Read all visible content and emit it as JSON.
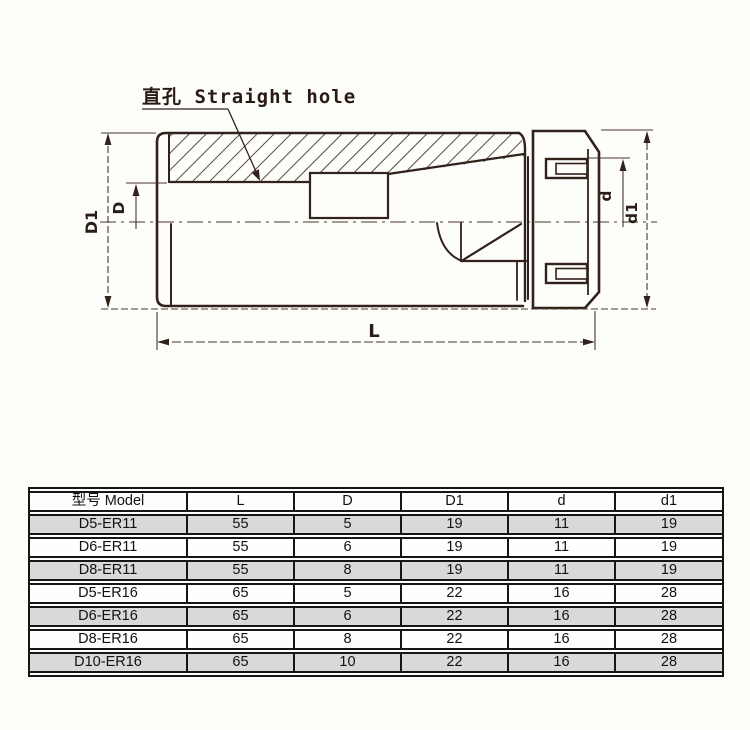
{
  "page": {
    "background": "#fdfdf9"
  },
  "drawing": {
    "label": "直孔 Straight hole",
    "dims": {
      "D1": "D1",
      "D": "D",
      "d": "d",
      "d1": "d1",
      "L": "L"
    },
    "line_color": "#33211b",
    "dim_line_color": "#4a362e",
    "hatch_color": "#3a261f"
  },
  "table": {
    "header": [
      "型号 Model",
      "L",
      "D",
      "D1",
      "d",
      "d1"
    ],
    "rows": [
      [
        "D5-ER11",
        "55",
        "5",
        "19",
        "11",
        "19"
      ],
      [
        "D6-ER11",
        "55",
        "6",
        "19",
        "11",
        "19"
      ],
      [
        "D8-ER11",
        "55",
        "8",
        "19",
        "11",
        "19"
      ],
      [
        "D5-ER16",
        "65",
        "5",
        "22",
        "16",
        "28"
      ],
      [
        "D6-ER16",
        "65",
        "6",
        "22",
        "16",
        "28"
      ],
      [
        "D8-ER16",
        "65",
        "8",
        "22",
        "16",
        "28"
      ],
      [
        "D10-ER16",
        "65",
        "10",
        "22",
        "16",
        "28"
      ]
    ],
    "shade_color": "#d9d9d9",
    "border_color": "#161616"
  }
}
